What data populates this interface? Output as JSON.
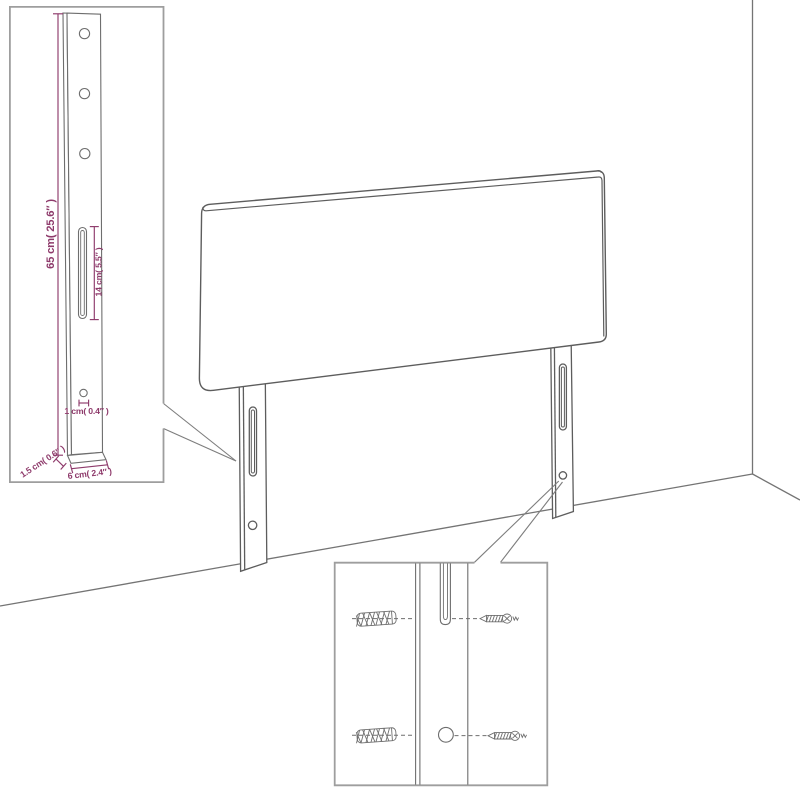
{
  "colors": {
    "main_line": "#5d5d5d",
    "wall_line": "#747474",
    "inset_line": "#6e6e6e",
    "dimension_color": "#8e3a6b",
    "inset_border": "#9e9e9e",
    "background": "#ffffff"
  },
  "leg_detail_inset": {
    "height_label": "65 cm( 25.6″ )",
    "slot_label": "14 cm( 5.5″ )",
    "hole_label": "1 cm( 0.4″ )",
    "thickness_label": "1.5 cm( 0.6″ )",
    "width_label": "6 cm( 2.4″ )"
  }
}
